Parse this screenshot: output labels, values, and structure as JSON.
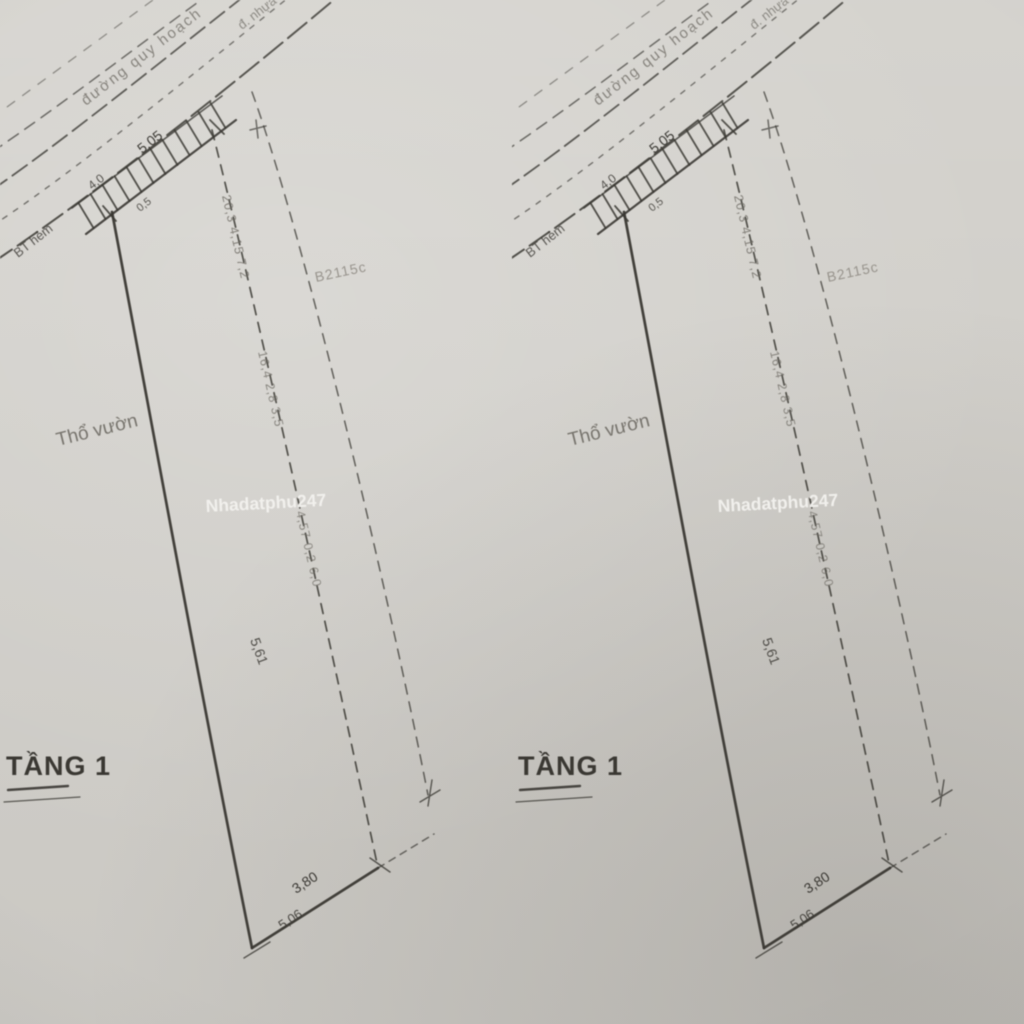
{
  "colors": {
    "paper": "#d3d1cc",
    "ink": "#3b3934",
    "faint": "#6e6b64",
    "muted": "#8d8982",
    "watermark": "#f5f4f1"
  },
  "panel": {
    "road": {
      "label_upper": "đường quy hoạch",
      "label_right": "đ. nhựa",
      "label_alley": "BT hẻm"
    },
    "dimensions": {
      "front": "5,05",
      "road_width": "4,0",
      "offset": "0,5",
      "side_mid": "5,61",
      "bottom_upper": "3,80",
      "bottom_lower": "5,06"
    },
    "boundary_annotations": {
      "run1": "20,3 4,15 7,2",
      "run2": "16,4 2,8 3,5",
      "run3": "4,57 0,2 6,0"
    },
    "labels": {
      "land_type": "Thổ vườn",
      "parcel_code": "B2115c",
      "floor": "TẦNG 1"
    },
    "watermark": "Nhadatphu247"
  }
}
